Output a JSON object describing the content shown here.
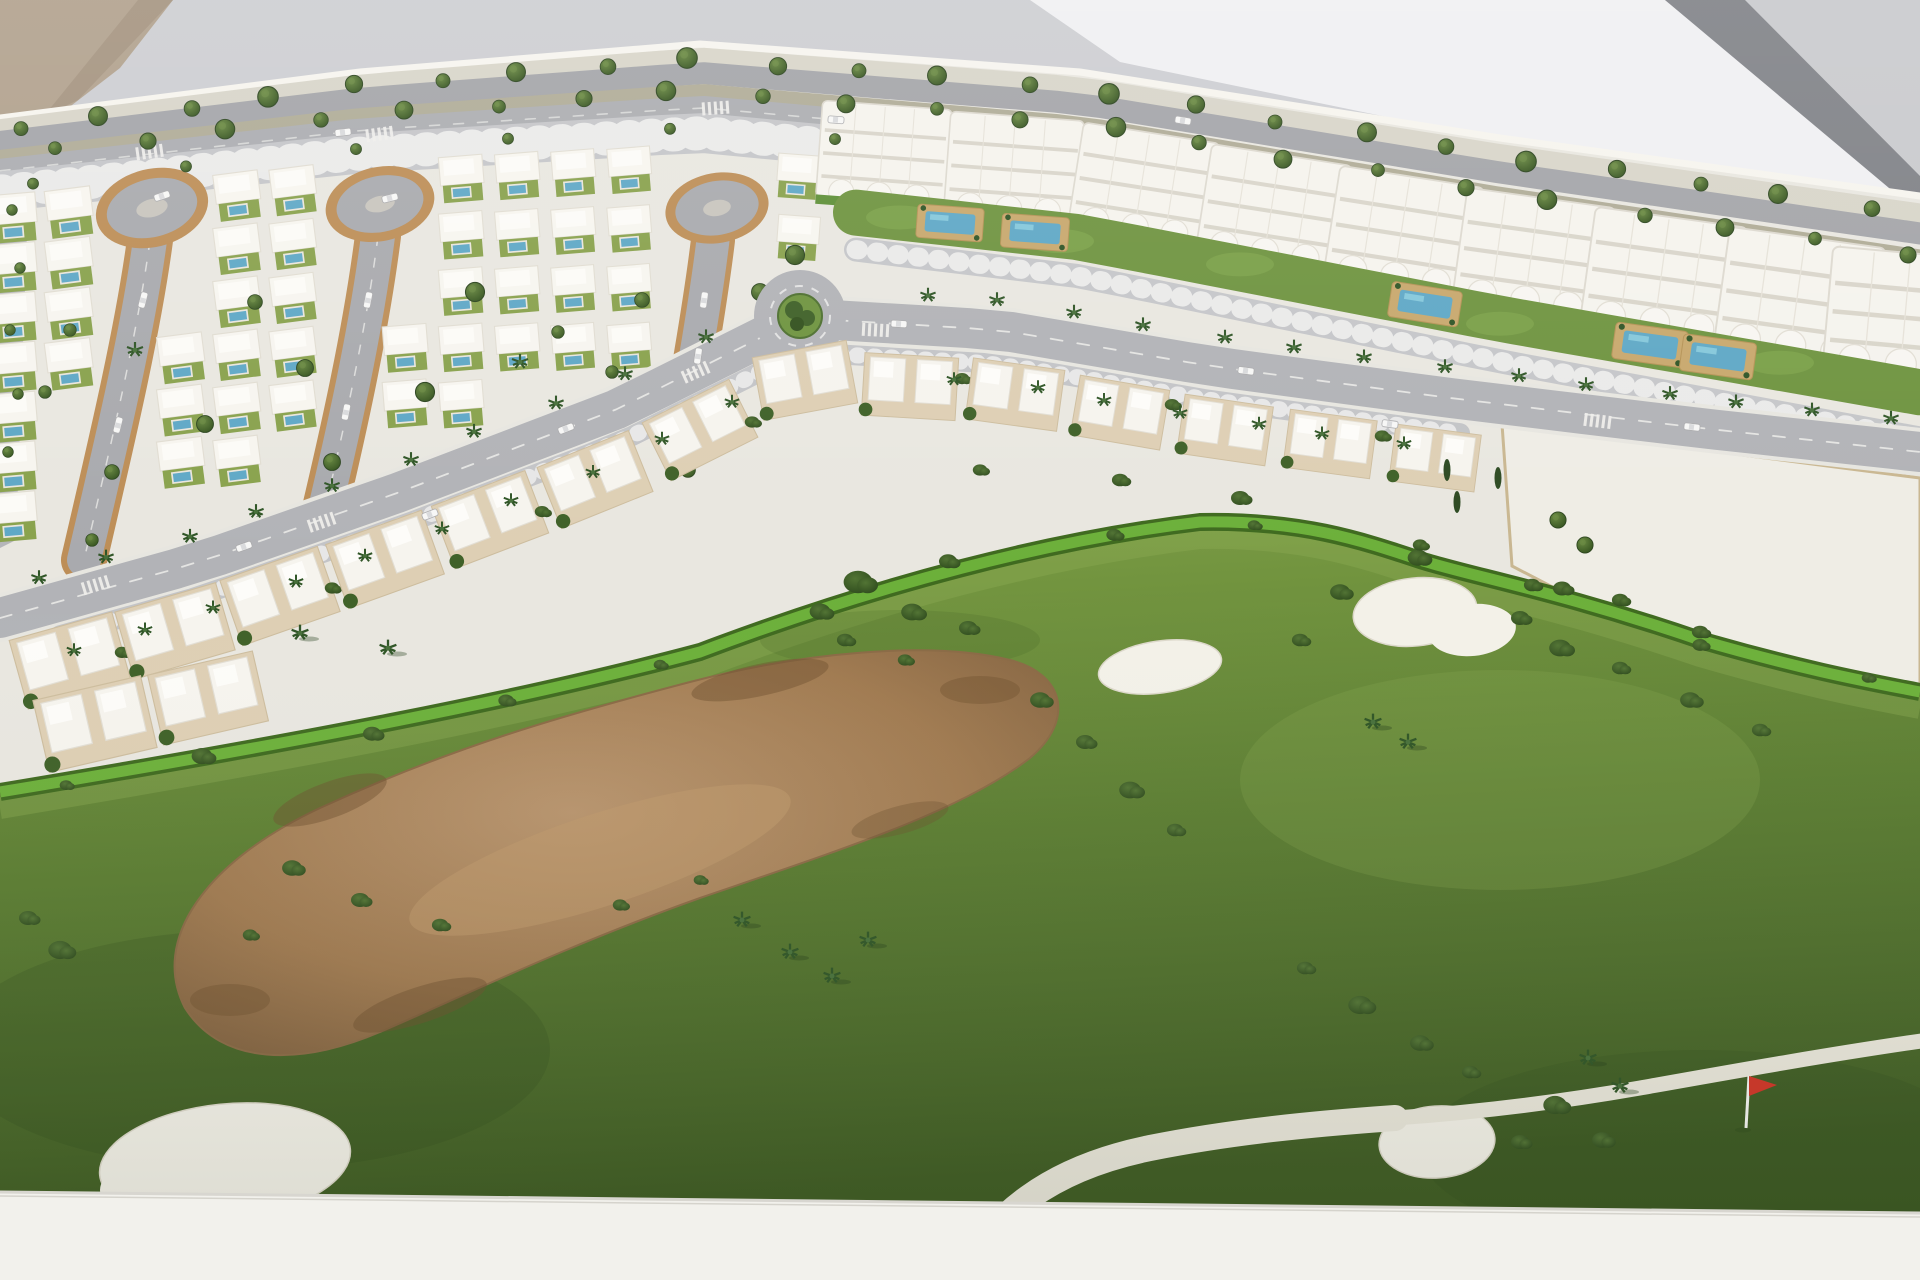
{
  "scene": {
    "medium": "photograph of an architectural scale model (maquette)",
    "subject": "master plan model of a golf resort residential development",
    "setting": "white model board on a plinth, photographed at an angle against a grey wall",
    "no_visible_text": true,
    "palette": {
      "wall_gray": "#cdced2",
      "wall_bright": "#f0f0f2",
      "wall_stripe": "#808287",
      "corner_tan": "#b1a18d",
      "board_white": "#e9e7e0",
      "building_white": "#f6f4ee",
      "road_gray": "#a9aaae",
      "avenue_gray": "#b2b3b7",
      "parking_gray": "#c5c6c9",
      "curb_tan": "#bd8e57",
      "garden_green": "#89a24d",
      "hedge_green": "#6cb03a",
      "golf_light_green": "#7ea046",
      "golf_dark_green": "#3f5c23",
      "sand_tan": "#a9835c",
      "bunker_white": "#f3f1e8",
      "pool_blue": "#5fa8c6",
      "tree_dark_green": "#33511e",
      "palm_green": "#2f5526",
      "flag_red": "#d03426",
      "plinth_white": "#f2f1ec"
    },
    "districts": {
      "villa_quarter": {
        "label": "detached villas with private pools around three cul-de-sac lanes",
        "approx_villas": 45,
        "cul_de_sac_lanes": 3
      },
      "apartment_row": {
        "label": "white apartment blocks with wavy balcony fronts",
        "approx_blocks": 9,
        "communal_pools": 5
      },
      "townhouse_row": {
        "label": "semi-detached townhouses along the curved avenue",
        "approx_pairs": 16
      },
      "vacant_plot": {
        "label": "blank white future-phase plot"
      },
      "golf_course": {
        "bunkers": 4,
        "flags": 1,
        "cart_paths": 1,
        "waste_area": "large sandy waste area with scrub bushes"
      }
    },
    "roads": {
      "boulevard": "tree-lined dual carriageway along the top edge with parking strip",
      "avenue": "palm-lined curved avenue through the centre",
      "roundabout": 1,
      "crosswalks": 8
    }
  }
}
